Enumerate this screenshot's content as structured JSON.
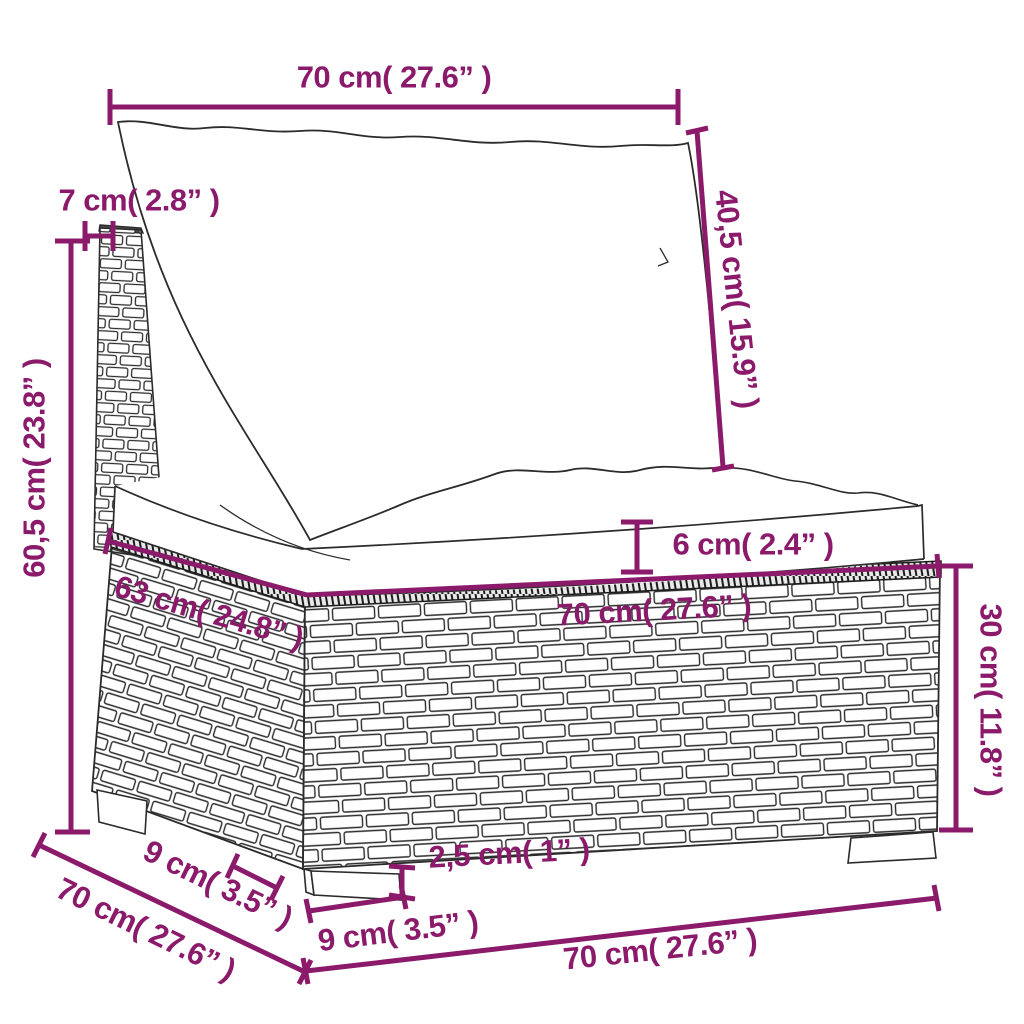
{
  "figure": {
    "subject": "Poly rattan garden sofa middle section with back cushion and seat cushion - dimension diagram",
    "background_color": "#ffffff",
    "accent_color": "#8B1A6B",
    "outline_color": "#2b2b2b"
  },
  "dimensions": {
    "top_width": {
      "label": "70 cm( 27.6” )",
      "cm": "70",
      "inches": "27.6"
    },
    "back_panel_thickness": {
      "label": "7 cm( 2.8” )",
      "cm": "7",
      "inches": "2.8"
    },
    "backrest_height": {
      "label": "40,5 cm( 15.9” )",
      "cm": "40,5",
      "inches": "15.9"
    },
    "total_height": {
      "label": "60,5 cm( 23.8” )",
      "cm": "60,5",
      "inches": "23.8"
    },
    "seat_depth": {
      "label": "63 cm( 24.8” )",
      "cm": "63",
      "inches": "24.8"
    },
    "seat_cushion_thickness": {
      "label": "6 cm( 2.4” )",
      "cm": "6",
      "inches": "2.4"
    },
    "base_top_width": {
      "label": "70 cm( 27.6” )",
      "cm": "70",
      "inches": "27.6"
    },
    "base_height": {
      "label": "30 cm( 11.8” )",
      "cm": "30",
      "inches": "11.8"
    },
    "foot_height": {
      "label": "2,5 cm( 1” )",
      "cm": "2,5",
      "inches": "1"
    },
    "foot_width": {
      "label": "9 cm( 3.5” )",
      "cm": "9",
      "inches": "3.5"
    },
    "base_depth": {
      "label": "70 cm( 27.6” )",
      "cm": "70",
      "inches": "27.6"
    },
    "foot_depth": {
      "label": "9 cm( 3.5” )",
      "cm": "9",
      "inches": "3.5"
    },
    "bottom_width": {
      "label": "70 cm( 27.6” )",
      "cm": "70",
      "inches": "27.6"
    }
  }
}
